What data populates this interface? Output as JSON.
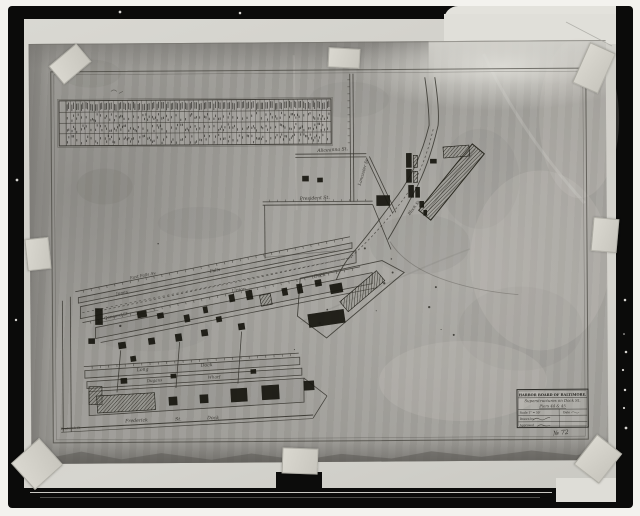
{
  "map": {
    "streets": {
      "aliceanna": "Aliceanna St.",
      "lancaster": "Lancaster St",
      "president": "President St.",
      "concord": "Concord St",
      "east_falls": "East Falls Av.",
      "jones": "Jones",
      "falls": "Falls",
      "union": "Union",
      "union_dock": "Dock",
      "long": "Long",
      "long_dock": "Dock",
      "dugans": "Dugans",
      "wharf": "Wharf",
      "frederick": "Frederick",
      "frederick_st": "St.",
      "frederick_dock": "Dock",
      "block_st": "Block St",
      "frederick_margin": "Frederick St"
    },
    "title_block": {
      "agency": "HARBOR BOARD OF BALTIMORE.",
      "subject": "Superstructures on Dock St.",
      "piers": "Piers 44 & 45",
      "scale": "Scale 1\" = 50'",
      "date": "Date",
      "drawn": "Drawn by",
      "approved": "Approved",
      "number": "№ 72"
    },
    "table": {
      "columns": 56,
      "rows": 4
    }
  }
}
